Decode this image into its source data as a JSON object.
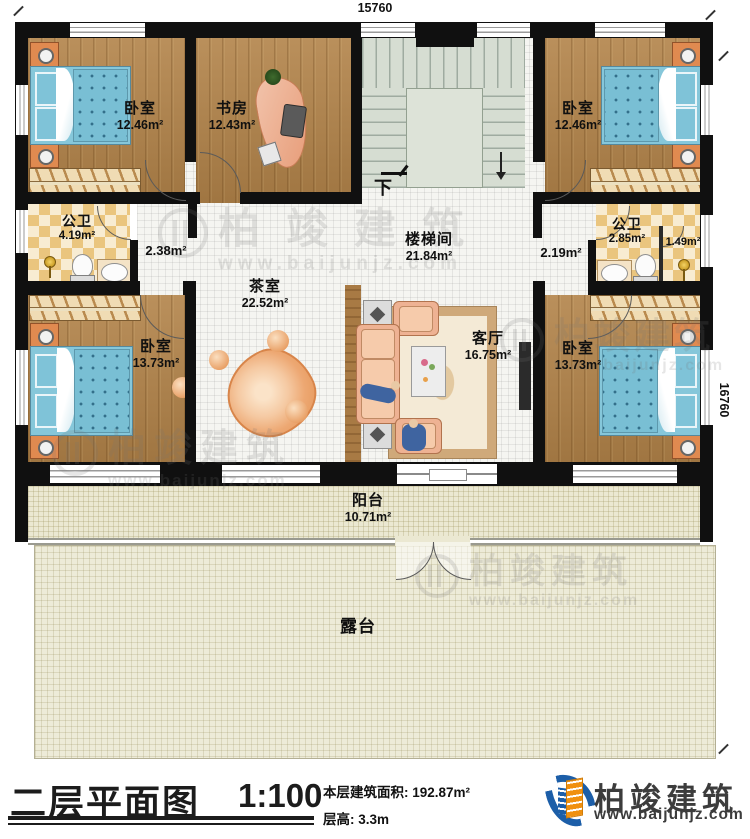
{
  "dimensions": {
    "top": "15760",
    "right": "16760"
  },
  "rooms": {
    "bedroom_tl": {
      "name": "卧室",
      "area": "12.46m²"
    },
    "study": {
      "name": "书房",
      "area": "12.43m²"
    },
    "bedroom_tr": {
      "name": "卧室",
      "area": "12.46m²"
    },
    "bath_left": {
      "name": "公卫",
      "area": "4.19m²"
    },
    "hall_left": {
      "area": "2.38m²"
    },
    "stairwell": {
      "name": "楼梯间",
      "area": "21.84m²"
    },
    "hall_right": {
      "area": "2.19m²"
    },
    "bath_right": {
      "name": "公卫",
      "area": "2.85m²"
    },
    "shower": {
      "area": "1.49m²"
    },
    "tea_room": {
      "name": "茶室",
      "area": "22.52m²"
    },
    "living_room": {
      "name": "客厅",
      "area": "16.75m²"
    },
    "bedroom_bl": {
      "name": "卧室",
      "area": "13.73m²"
    },
    "bedroom_br": {
      "name": "卧室",
      "area": "13.73m²"
    },
    "balcony": {
      "name": "阳台",
      "area": "10.71m²"
    },
    "terrace": {
      "name": "露台"
    }
  },
  "stair": {
    "down_label": "下"
  },
  "titleblock": {
    "title": "二层平面图",
    "scale": "1:100",
    "area_label": "本层建筑面积: 192.87m²",
    "floor_height_label": "层高: 3.3m"
  },
  "brand": {
    "name": "柏竣建筑",
    "url": "www.baijunjz.com"
  },
  "watermark": {
    "name": "柏竣建筑",
    "url": "www.baijunjz.com"
  }
}
